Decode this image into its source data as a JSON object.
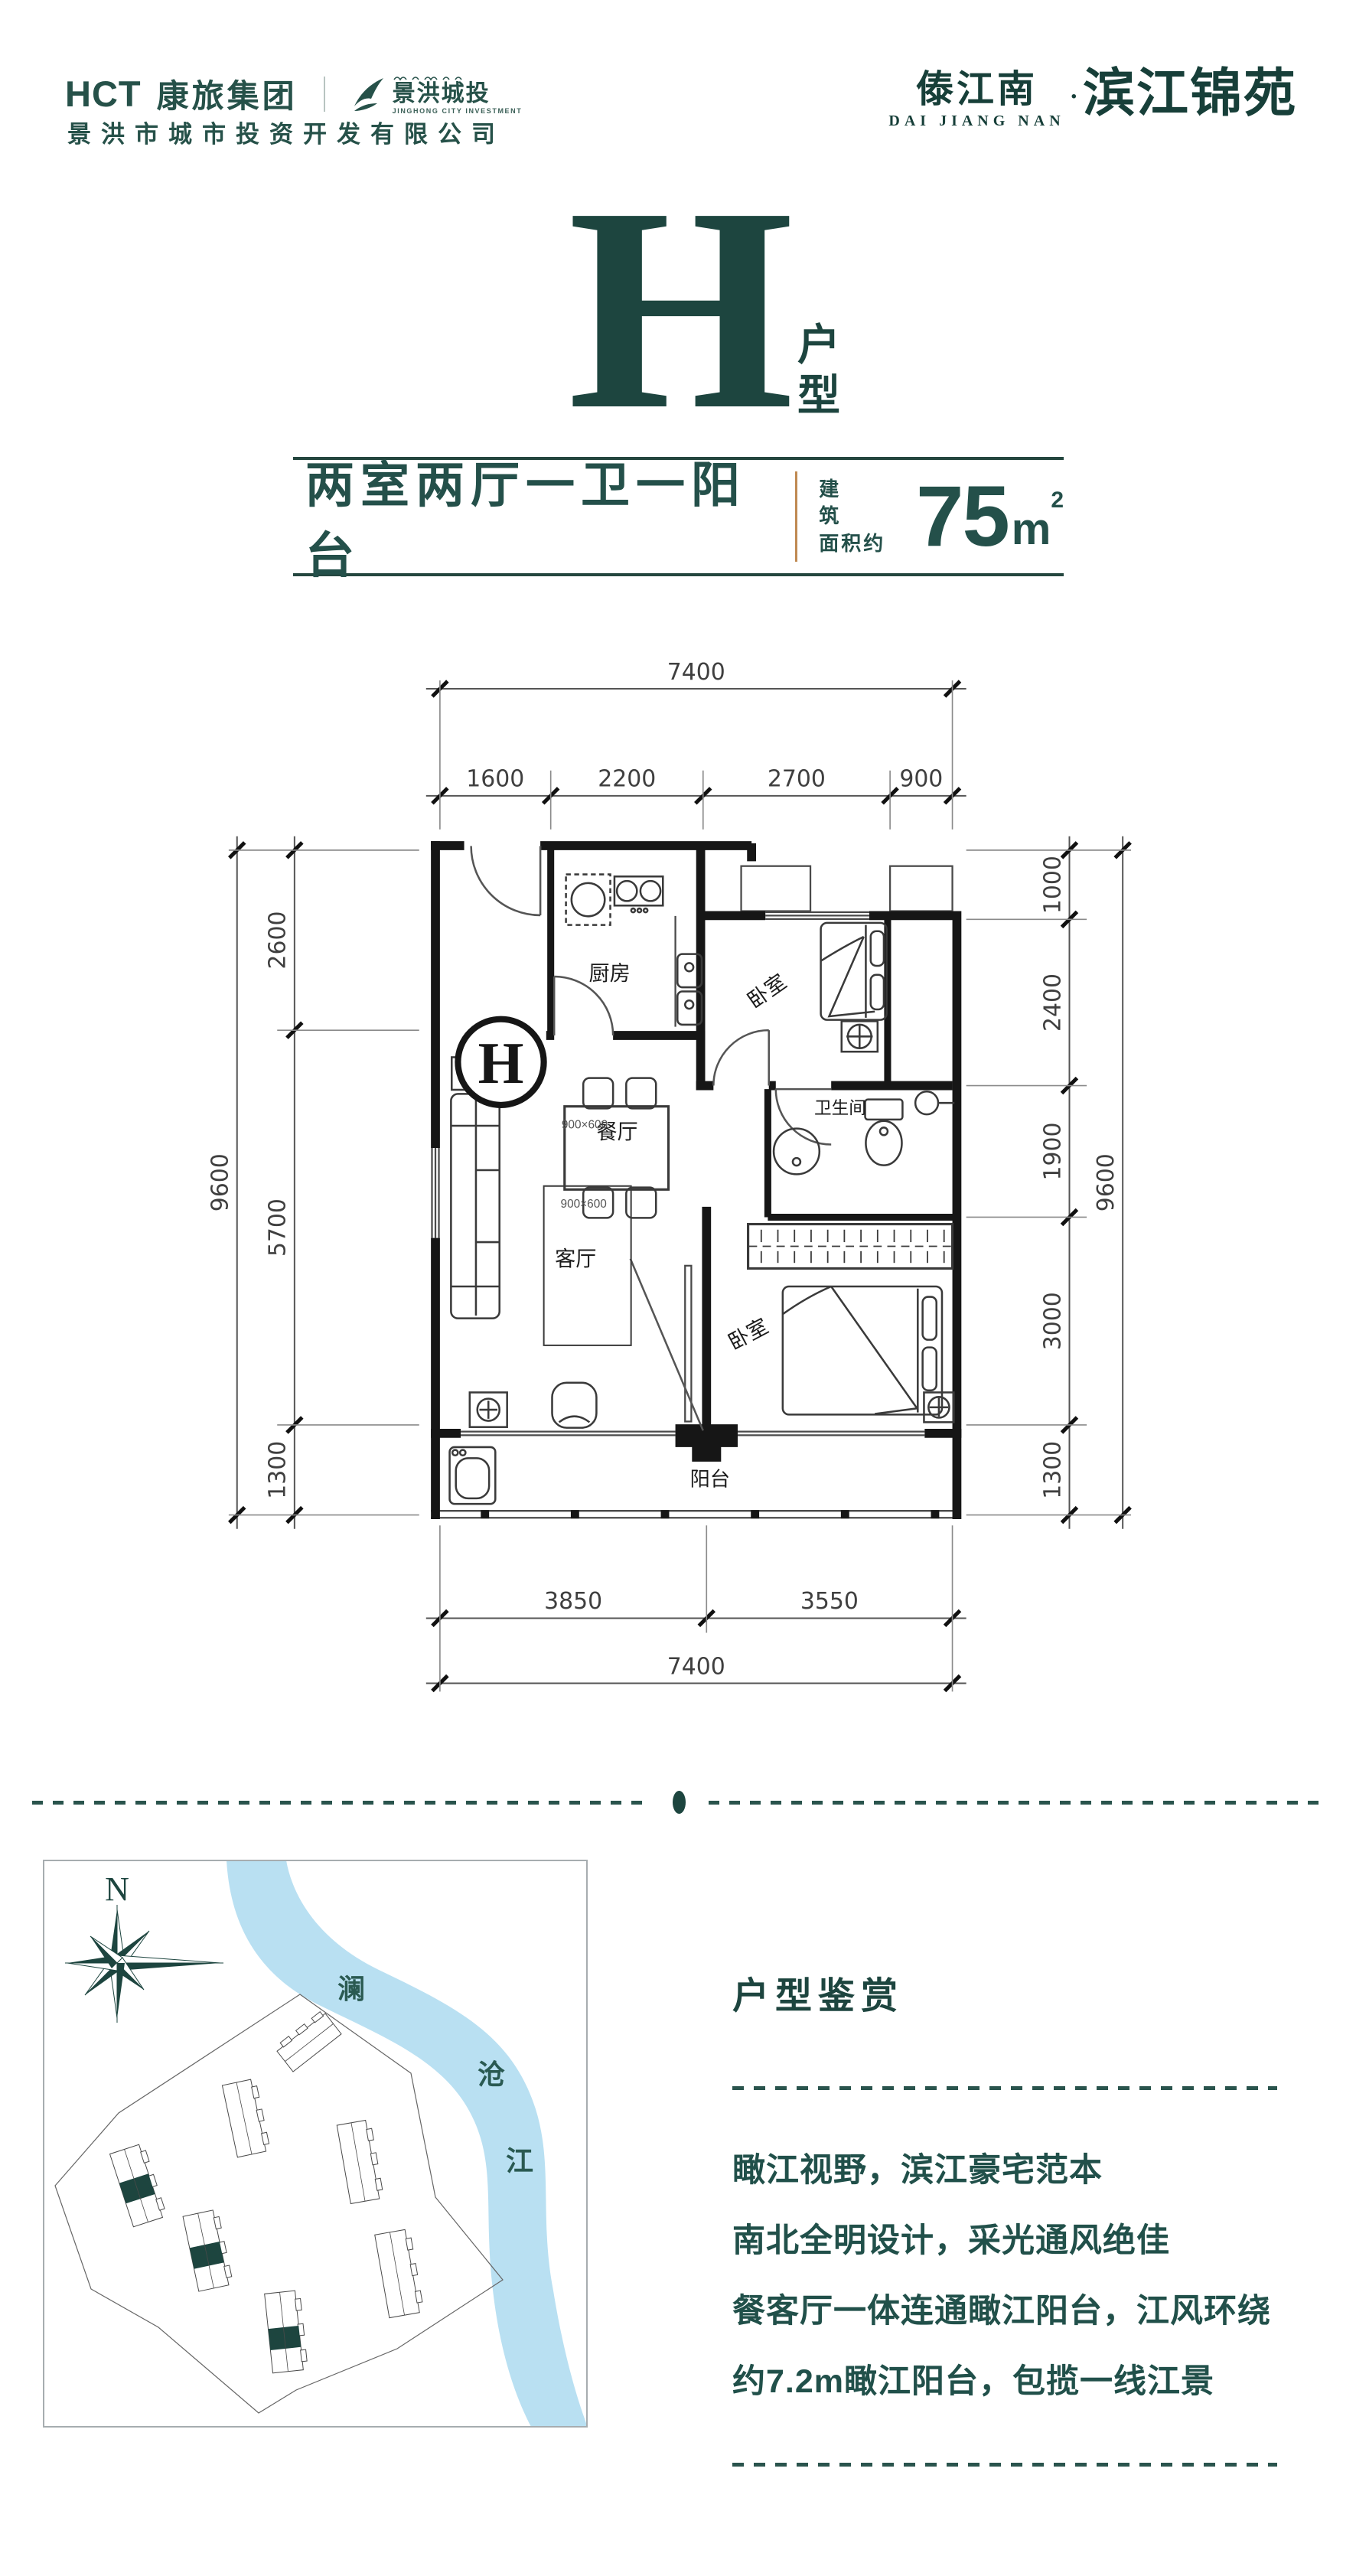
{
  "colors": {
    "teal": "#1f4a43",
    "tan": "#c08a52",
    "river": "#b9e0f2",
    "wall": "#161616"
  },
  "header": {
    "logo_hct": "HCT",
    "logo_hct_cn": "康旅集团",
    "logo2_cn": "景洪城投",
    "logo2_en": "JINGHONG CITY INVESTMENT",
    "company": "景洪市城市投资开发有限公司",
    "brand_small": "傣江南",
    "brand_dot": "·",
    "brand_big": "滨江锦苑",
    "brand_en": "DAI JIANG NAN"
  },
  "hero": {
    "letter": "H",
    "type_chars": [
      "户",
      "型"
    ]
  },
  "summary": {
    "layout": "两室两厅一卫一阳台",
    "area_label_top": "建筑",
    "area_label_bottom": "面积约",
    "area_value": "75",
    "area_unit": "m",
    "area_sup": "2"
  },
  "plan": {
    "marker": "H",
    "rooms": {
      "kitchen": "厨房",
      "bedroom1": "卧室",
      "bath": "卫生间",
      "dining": "餐厅",
      "living": "客厅",
      "bedroom2": "卧室",
      "balcony": "阳台"
    },
    "table_labels": [
      "900×600",
      "900×600"
    ],
    "dims": {
      "top_total": 7400,
      "top_segments": [
        1600,
        2200,
        2700,
        900
      ],
      "left_total": 9600,
      "left_segments": [
        2600,
        5700,
        1300
      ],
      "right_total": 9600,
      "right_segments": [
        1000,
        2400,
        1900,
        3000,
        1300
      ],
      "bottom_segments": [
        3850,
        3550
      ],
      "bottom_total": 7400
    }
  },
  "map": {
    "north": "N",
    "river": [
      "澜",
      "沧",
      "江"
    ]
  },
  "appreciation": {
    "title": "户型鉴赏",
    "lines": [
      "瞰江视野，滨江豪宅范本",
      "南北全明设计，采光通风绝佳",
      "餐客厅一体连通瞰江阳台，江风环绕",
      "约7.2m瞰江阳台，包揽一线江景"
    ]
  }
}
